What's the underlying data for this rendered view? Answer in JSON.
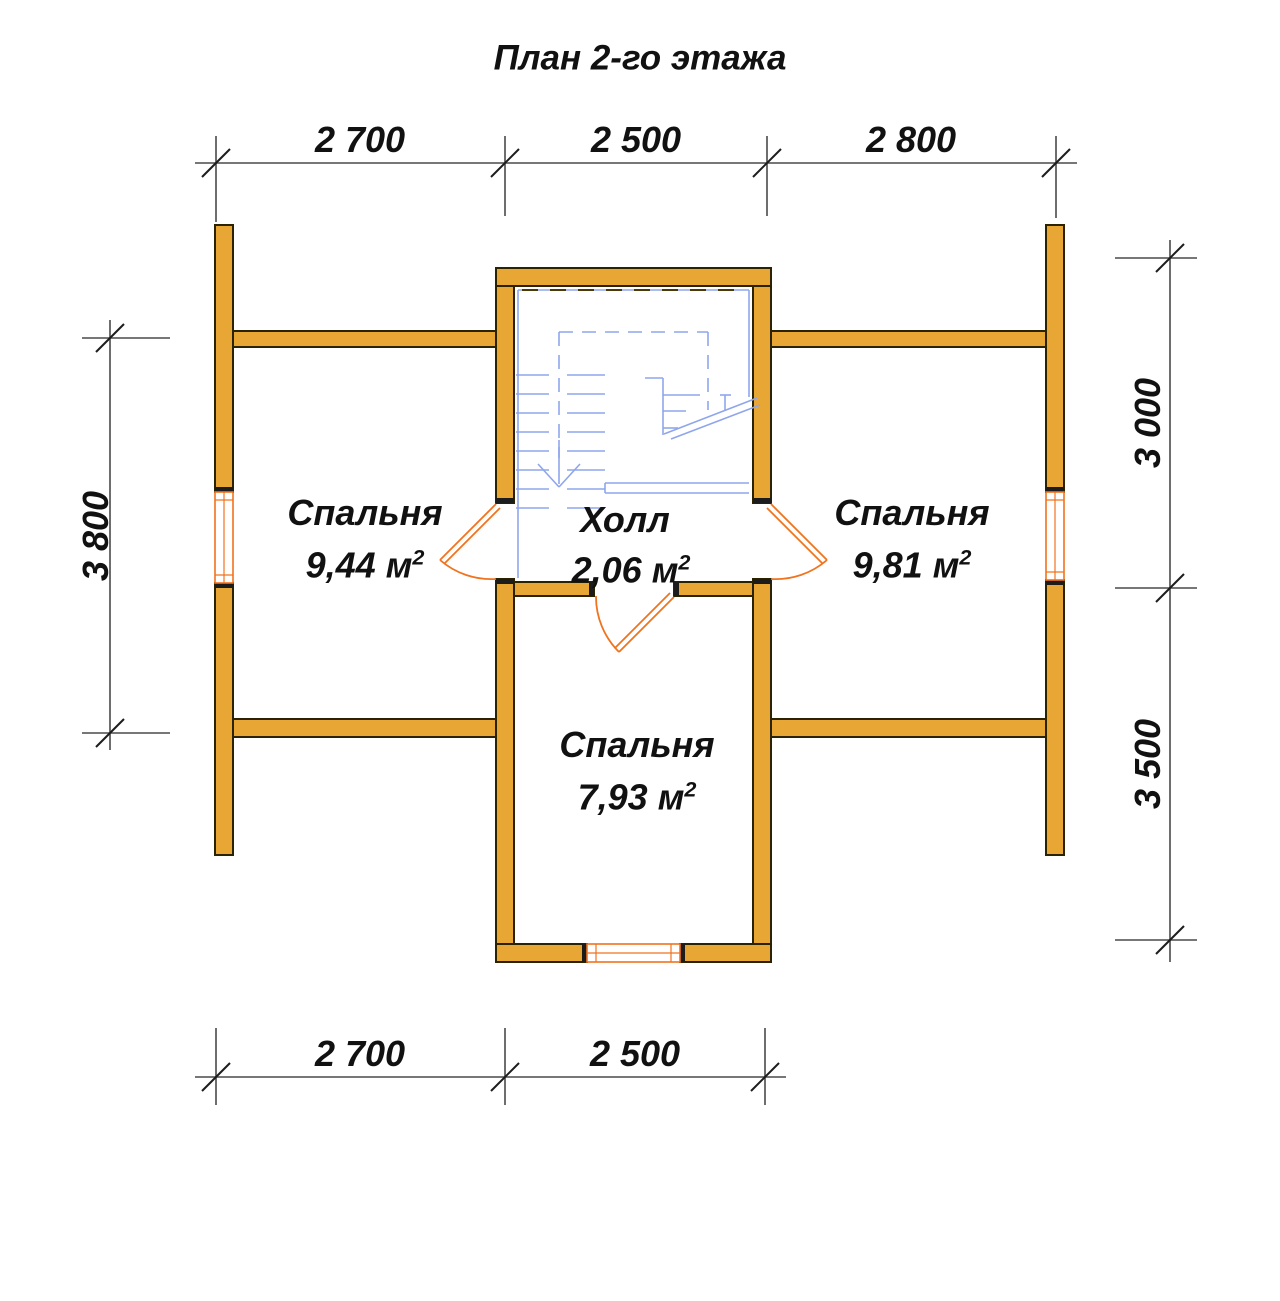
{
  "title": "План 2-го этажа",
  "colors": {
    "wall_fill": "#E8A735",
    "wall_outline": "#2B2200",
    "opening_accent": "#F0731E",
    "stair_blue": "#8FA6EC",
    "dim_line": "#4A4A4A",
    "text": "#111111",
    "background": "#FFFFFF"
  },
  "dimensions": {
    "top": [
      "2 700",
      "2 500",
      "2 800"
    ],
    "bottom": [
      "2 700",
      "2 500"
    ],
    "left": [
      "3 800"
    ],
    "right": [
      "3 000",
      "3 500"
    ]
  },
  "rooms": [
    {
      "name": "Спальня",
      "area": "9,44 м",
      "area_exp": "2"
    },
    {
      "name": "Холл",
      "area": "2,06 м",
      "area_exp": "2"
    },
    {
      "name": "Спальня",
      "area": "9,81 м",
      "area_exp": "2"
    },
    {
      "name": "Спальня",
      "area": "7,93 м",
      "area_exp": "2"
    }
  ]
}
